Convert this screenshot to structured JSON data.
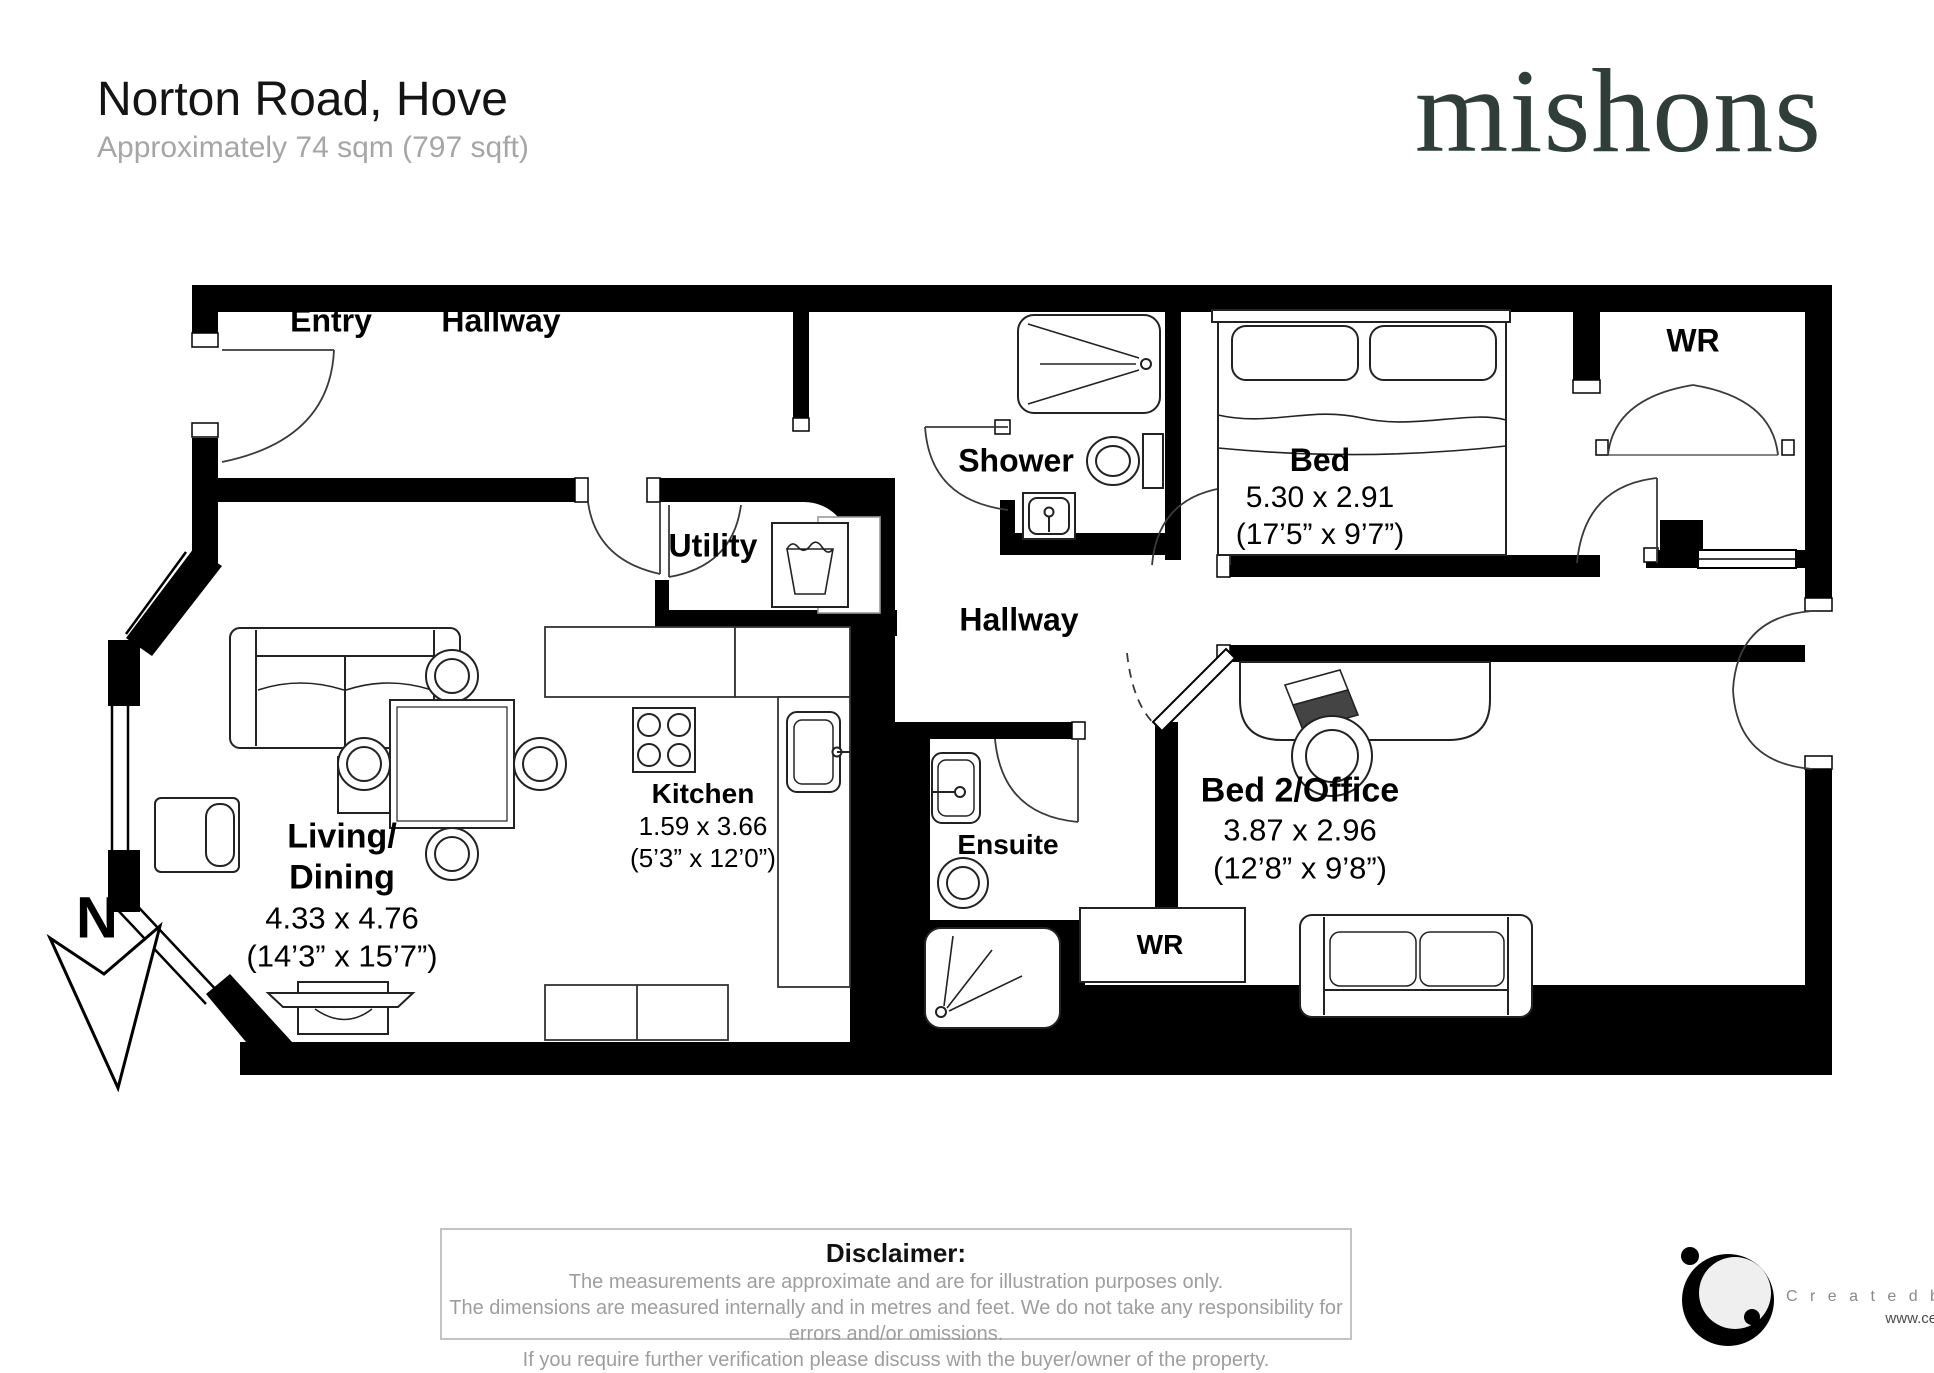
{
  "header": {
    "title": "Norton Road, Hove",
    "subtitle": "Approximately 74 sqm (797 sqft)"
  },
  "brand": {
    "logo": "mishons",
    "color": "#2f3e38"
  },
  "compass": {
    "n": "N"
  },
  "rooms": {
    "entry": {
      "label": "Entry"
    },
    "hallway1": {
      "label": "Hallway"
    },
    "utility": {
      "label": "Utility"
    },
    "shower": {
      "label": "Shower"
    },
    "bed": {
      "label": "Bed",
      "dim_m": "5.30 x 2.91",
      "dim_ft": "(17’5” x 9’7”)"
    },
    "wr_top": {
      "label": "WR"
    },
    "hallway2": {
      "label": "Hallway"
    },
    "kitchen": {
      "label": "Kitchen",
      "dim_m": "1.59 x 3.66",
      "dim_ft": "(5’3” x 12’0”)"
    },
    "living": {
      "line1": "Living/",
      "line2": "Dining",
      "dim_m": "4.33 x 4.76",
      "dim_ft": "(14’3” x 15’7”)"
    },
    "ensuite": {
      "label": "Ensuite"
    },
    "bed2": {
      "label": "Bed 2/Office",
      "dim_m": "3.87 x 2.96",
      "dim_ft": "(12’8” x 9’8”)"
    },
    "wr_bottom": {
      "label": "WR"
    }
  },
  "disclaimer": {
    "title": "Disclaimer:",
    "line1": "The measurements are approximate and are for illustration purposes only.",
    "line2": "The dimensions are measured internally and in metres and feet. We do not take any responsibility for errors and/or omissions.",
    "line3": "If you require further verification please discuss with the buyer/owner of the property."
  },
  "credits": {
    "created_by": "C r e a t e d   b y   C E N E S",
    "url": "www.cenes.co"
  }
}
